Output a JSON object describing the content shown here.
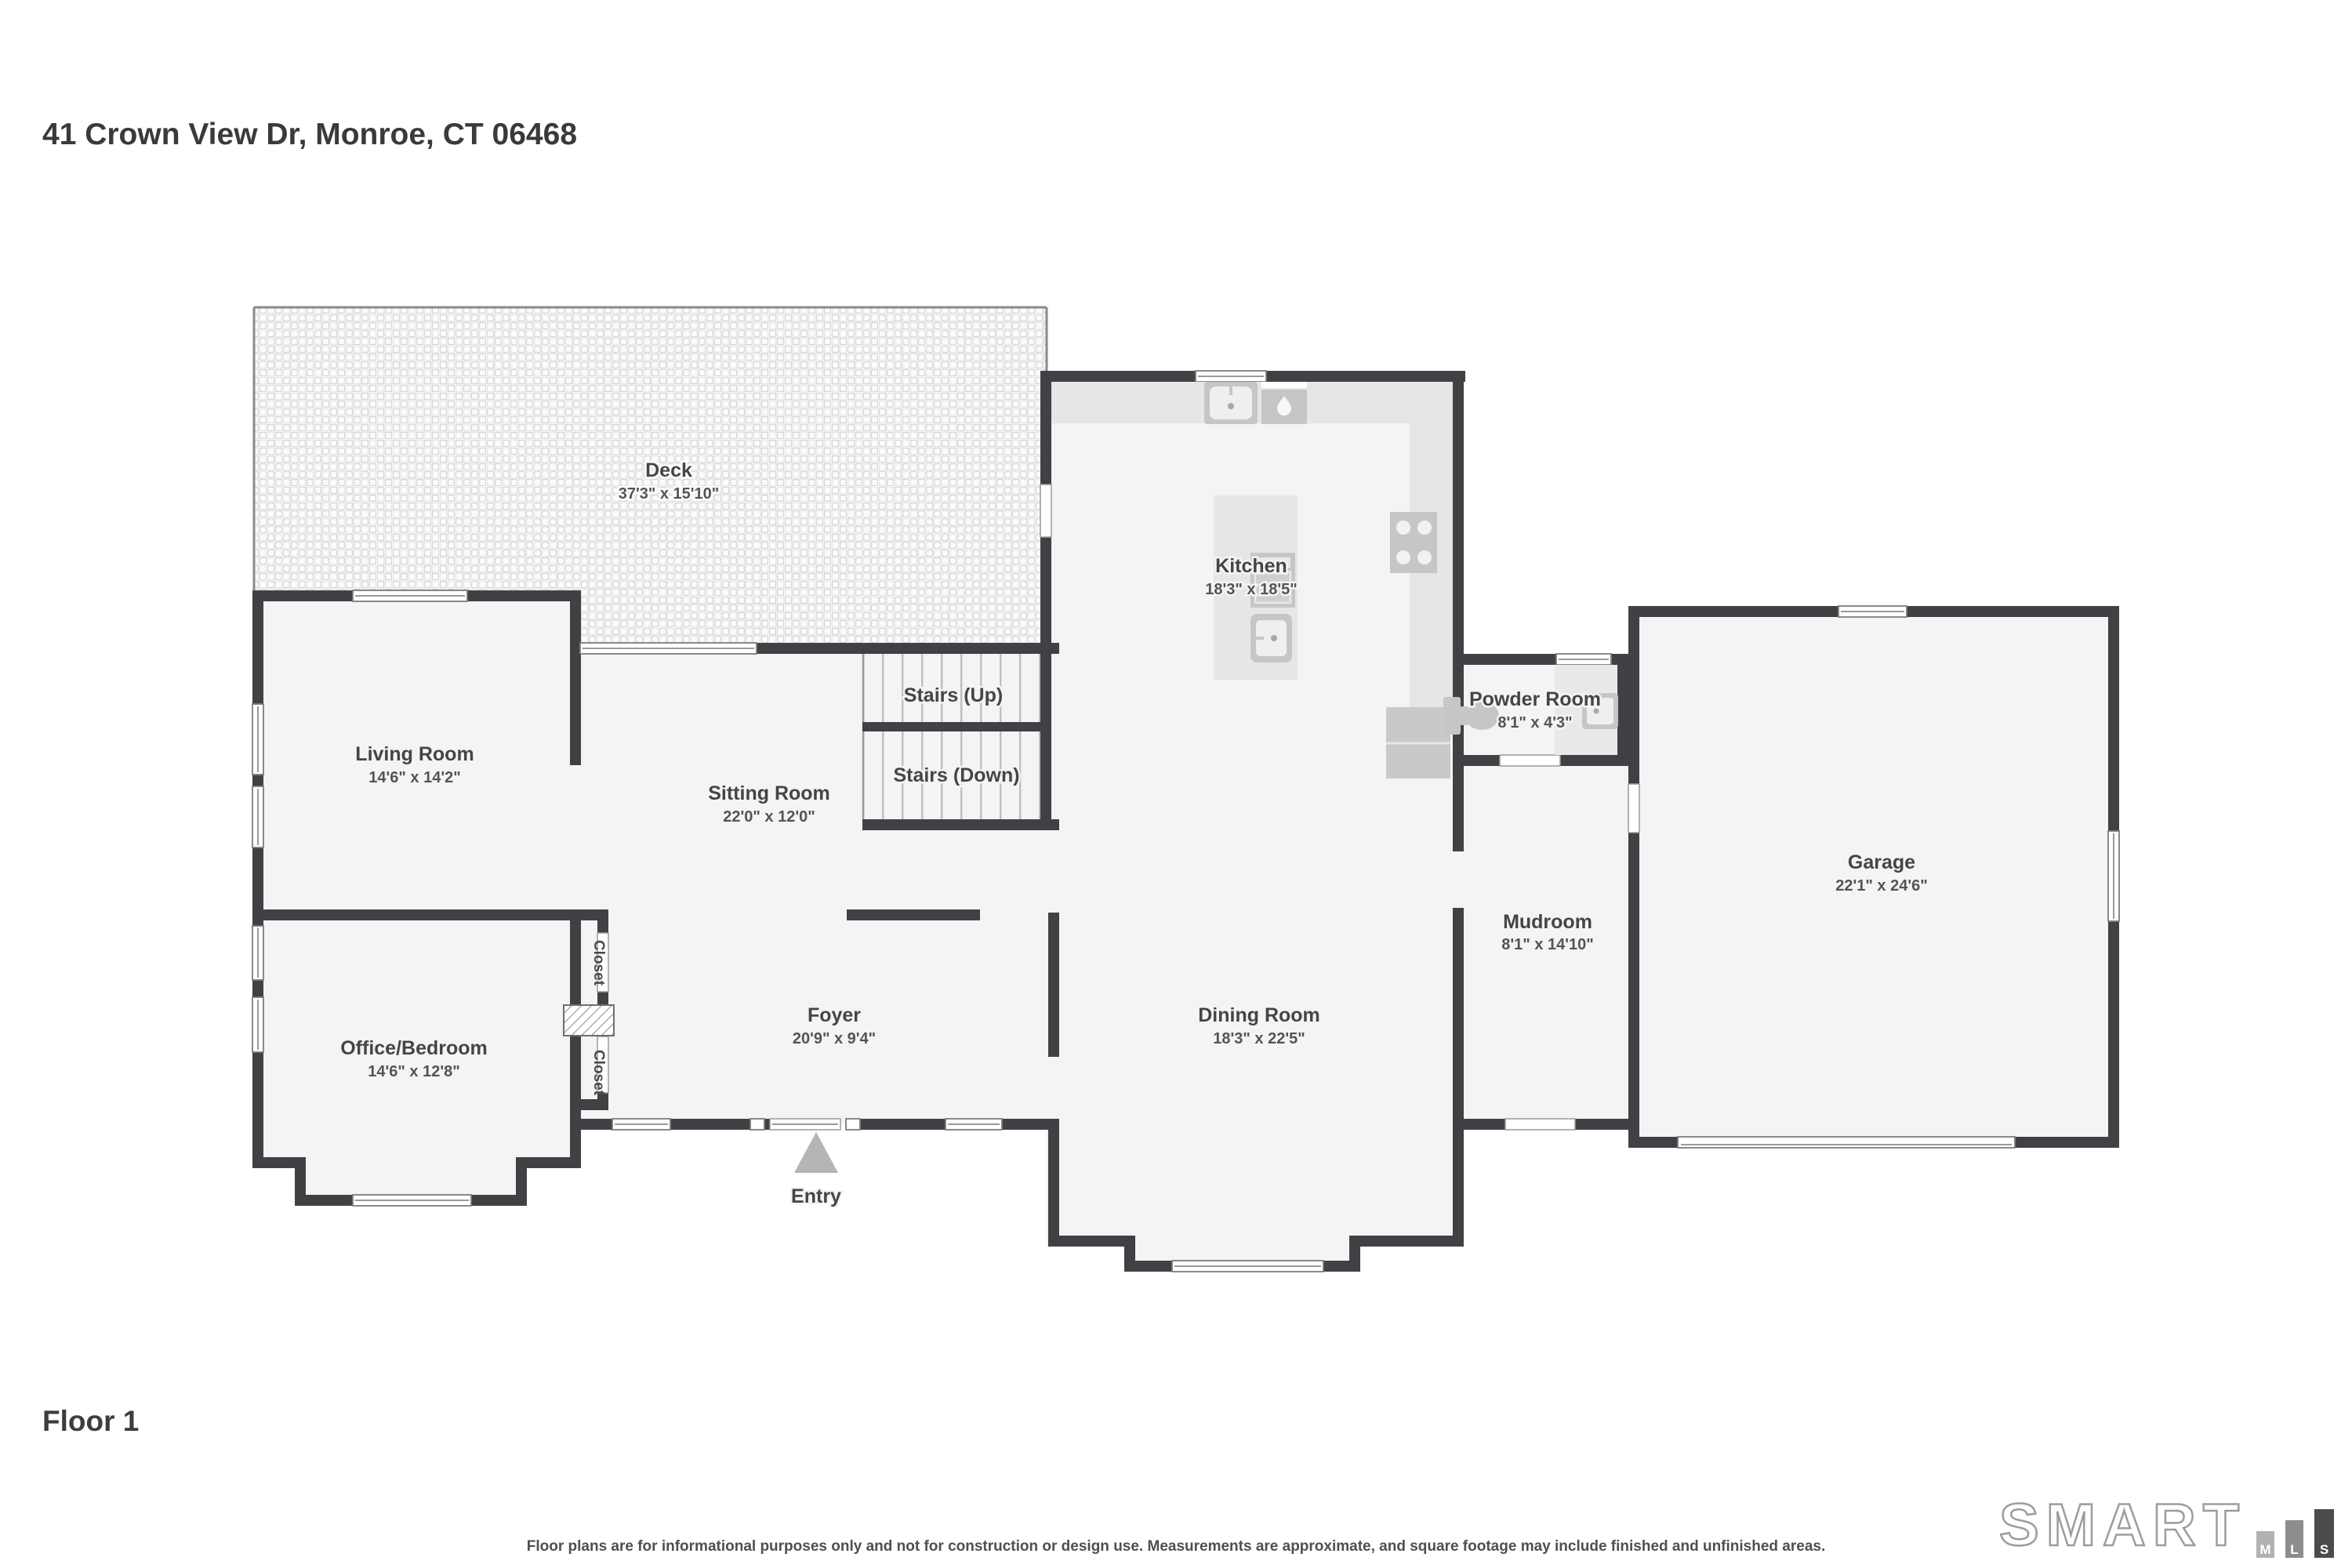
{
  "page": {
    "title": "41 Crown View Dr, Monroe, CT 06468",
    "floor_label": "Floor 1",
    "disclaimer": "Floor plans are for informational purposes only and not for construction or design use. Measurements are approximate, and square footage may include finished and unfinished areas."
  },
  "logo": {
    "brand": "SMART",
    "bars": [
      {
        "letter": "M",
        "color": "#b2b2b2"
      },
      {
        "letter": "L",
        "color": "#8d8d8d"
      },
      {
        "letter": "S",
        "color": "#4b4b4b"
      }
    ]
  },
  "colors": {
    "wall": "#3f4145",
    "room_fill": "#f4f4f4",
    "counter": "#e6e6e6",
    "fixture": "#c6c6c6",
    "label_text": "#454545",
    "dims_text": "#545454",
    "entry_arrow": "#b5b5b5",
    "deck_tile_line": "#d6d6d6"
  },
  "rooms": {
    "deck": {
      "name": "Deck",
      "dims": "37'3\" x 15'10\""
    },
    "kitchen": {
      "name": "Kitchen",
      "dims": "18'3\" x 18'5\""
    },
    "powder": {
      "name": "Powder Room",
      "dims": "8'1\" x 4'3\""
    },
    "garage": {
      "name": "Garage",
      "dims": "22'1\" x 24'6\""
    },
    "living": {
      "name": "Living Room",
      "dims": "14'6\" x 14'2\""
    },
    "sitting": {
      "name": "Sitting Room",
      "dims": "22'0\" x 12'0\""
    },
    "stairs_up": {
      "name": "Stairs (Up)"
    },
    "stairs_down": {
      "name": "Stairs (Down)"
    },
    "mudroom": {
      "name": "Mudroom",
      "dims": "8'1\" x 14'10\""
    },
    "office": {
      "name": "Office/Bedroom",
      "dims": "14'6\" x 12'8\""
    },
    "foyer": {
      "name": "Foyer",
      "dims": "20'9\" x 9'4\""
    },
    "dining": {
      "name": "Dining Room",
      "dims": "18'3\" x 22'5\""
    },
    "closet_a": {
      "name": "Closet"
    },
    "closet_b": {
      "name": "Closet"
    },
    "entry": {
      "name": "Entry"
    }
  }
}
